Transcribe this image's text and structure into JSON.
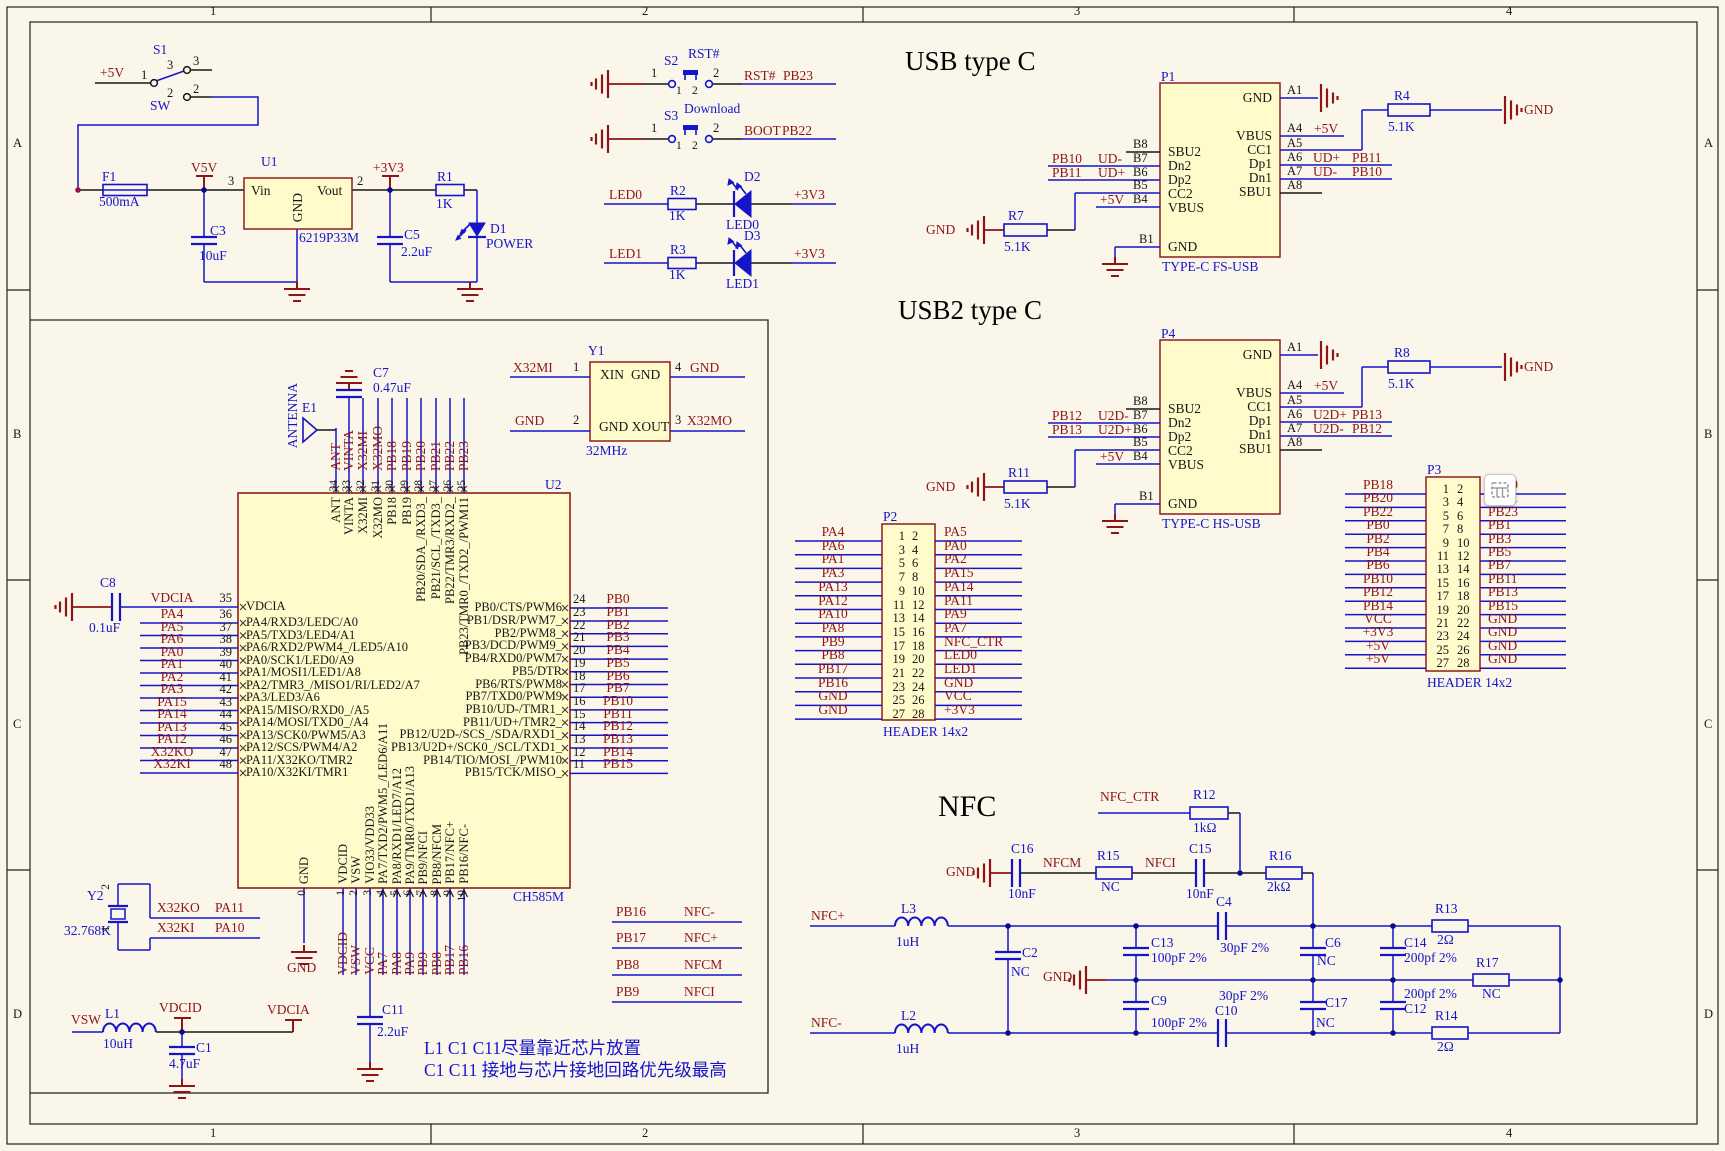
{
  "frame": {
    "cols": [
      "1",
      "2",
      "3",
      "4"
    ],
    "rows": [
      "A",
      "B",
      "C",
      "D"
    ]
  },
  "titles": {
    "usb1": "USB type C",
    "usb2": "USB2 type C",
    "nfc": "NFC"
  },
  "notes": [
    "L1 C1 C11尽量靠近芯片放置",
    "C1 C11 接地与芯片接地回路优先级最高"
  ],
  "power": {
    "p5v": "+5V",
    "s1_ref": "S1",
    "s1_sw": "SW",
    "s1_p1": "1",
    "s1_p2i": "2",
    "s1_p2o": "2",
    "s1_p3i": "3",
    "s1_p3o": "3",
    "f1_ref": "F1",
    "f1_val": "500mA",
    "v5v": "V5V",
    "u1_ref": "U1",
    "u1_vin": "Vin",
    "u1_vout": "Vout",
    "u1_gnd": "GND",
    "u1_val": "6219P33M",
    "u1_pin3": "3",
    "u1_pin2": "2",
    "p3v3": "+3V3",
    "r1_ref": "R1",
    "r1_val": "1K",
    "d1_ref": "D1",
    "d1_val": "POWER",
    "c3_ref": "C3",
    "c3_val": "10uF",
    "c5_ref": "C5",
    "c5_val": "2.2uF"
  },
  "buttons": {
    "s2_ref": "S2",
    "s2_val": "RST#",
    "s2_p1": "1",
    "s2_p2": "2",
    "s2_p1i": "1",
    "s2_p2i": "2",
    "s2_net1": "RST#",
    "s2_net2": "PB23",
    "s3_ref": "S3",
    "s3_val": "Download",
    "s3_p1": "1",
    "s3_p2": "2",
    "s3_p1i": "1",
    "s3_p2i": "2",
    "s3_net1": "BOOT",
    "s3_net2": "PB22",
    "led0_net": "LED0",
    "r2_ref": "R2",
    "r2_val": "1K",
    "d2_ref": "D2",
    "d2_val": "LED0",
    "led0_vcc": "+3V3",
    "led1_net": "LED1",
    "r3_ref": "R3",
    "r3_val": "1K",
    "d3_ref": "D3",
    "d3_val": "LED1",
    "led1_vcc": "+3V3"
  },
  "usb1": {
    "ref": "P1",
    "type": "TYPE-C FS-USB",
    "gnd": "GND",
    "a1": "A1",
    "gnd_a1": "GND",
    "vbus_r": "VBUS",
    "a4": "A4",
    "a4_net": "+5V",
    "cc1": "CC1",
    "a5": "A5",
    "r_top_ref": "R4",
    "r_top_val": "5.1K",
    "dp1": "Dp1",
    "a6": "A6",
    "a6_net": "UD+",
    "a6_net2": "PB11",
    "dn1": "Dn1",
    "a7": "A7",
    "a7_net": "UD-",
    "a7_net2": "PB10",
    "sbu1": "SBU1",
    "a8": "A8",
    "b8": "B8",
    "sbu2": "SBU2",
    "b7": "B7",
    "b7_net": "PB10",
    "b7_net2": "UD-",
    "dn2": "Dn2",
    "b6": "B6",
    "b6_net": "PB11",
    "b6_net2": "UD+",
    "dp2": "Dp2",
    "b5": "B5",
    "cc2": "CC2",
    "b4": "B4",
    "b4_net": "+5V",
    "vbus_l": "VBUS",
    "b1": "B1",
    "gnd_b1": "GND",
    "r_cc_ref": "R7",
    "r_cc_val": "5.1K"
  },
  "usb2": {
    "ref": "P4",
    "type": "TYPE-C HS-USB",
    "gnd": "GND",
    "a1": "A1",
    "gnd_a1": "GND",
    "vbus_r": "VBUS",
    "a4": "A4",
    "a4_net": "+5V",
    "cc1": "CC1",
    "a5": "A5",
    "r_top_ref": "R8",
    "r_top_val": "5.1K",
    "dp1": "Dp1",
    "a6": "A6",
    "a6_net": "U2D+",
    "a6_net2": "PB13",
    "dn1": "Dn1",
    "a7": "A7",
    "a7_net": "U2D-",
    "a7_net2": "PB12",
    "sbu1": "SBU1",
    "a8": "A8",
    "b8": "B8",
    "sbu2": "SBU2",
    "b7": "B7",
    "b7_net": "PB12",
    "b7_net2": "U2D-",
    "dn2": "Dn2",
    "b6": "B6",
    "b6_net": "PB13",
    "b6_net2": "U2D+",
    "dp2": "Dp2",
    "b5": "B5",
    "cc2": "CC2",
    "b4": "B4",
    "b4_net": "+5V",
    "vbus_l": "VBUS",
    "b1": "B1",
    "gnd_b1": "GND",
    "r_cc_ref": "R11",
    "r_cc_val": "5.1K"
  },
  "mcu": {
    "ref": "U2",
    "part": "CH585M",
    "e1_ref": "E1",
    "antenna": "ANTENNA",
    "c7_ref": "C7",
    "c7_val": "0.47uF",
    "c8_ref": "C8",
    "c8_val": "0.1uF",
    "left": [
      {
        "num": "35",
        "net": "VDCIA",
        "name": "VDCIA"
      },
      {
        "num": "36",
        "net": "PA4",
        "name": "PA4/RXD3/LEDC/A0"
      },
      {
        "num": "37",
        "net": "PA5",
        "name": "PA5/TXD3/LED4/A1"
      },
      {
        "num": "38",
        "net": "PA6",
        "name": "PA6/RXD2/PWM4_/LED5/A10"
      },
      {
        "num": "39",
        "net": "PA0",
        "name": "PA0/SCK1/LED0/A9"
      },
      {
        "num": "40",
        "net": "PA1",
        "name": "PA1/MOSI1/LED1/A8"
      },
      {
        "num": "41",
        "net": "PA2",
        "name": "PA2/TMR3_/MISO1/RI/LED2/A7"
      },
      {
        "num": "42",
        "net": "PA3",
        "name": "PA3/LED3/A6"
      },
      {
        "num": "43",
        "net": "PA15",
        "name": "PA15/MISO/RXD0_/A5"
      },
      {
        "num": "44",
        "net": "PA14",
        "name": "PA14/MOSI/TXD0_/A4"
      },
      {
        "num": "45",
        "net": "PA13",
        "name": "PA13/SCK0/PWM5/A3"
      },
      {
        "num": "46",
        "net": "PA12",
        "name": "PA12/SCS/PWM4/A2"
      },
      {
        "num": "47",
        "net": "X32KO",
        "name": "PA11/X32KO/TMR2"
      },
      {
        "num": "48",
        "net": "X32KI",
        "name": "PA10/X32KI/TMR1"
      }
    ],
    "right": [
      {
        "num": "24",
        "net": "PB0",
        "name": "PB0/CTS/PWM6"
      },
      {
        "num": "23",
        "net": "PB1",
        "name": "PB1/DSR/PWM7_"
      },
      {
        "num": "22",
        "net": "PB2",
        "name": "PB2/PWM8_"
      },
      {
        "num": "21",
        "net": "PB3",
        "name": "PB3/DCD/PWM9_"
      },
      {
        "num": "20",
        "net": "PB4",
        "name": "PB4/RXD0/PWM7"
      },
      {
        "num": "19",
        "net": "PB5",
        "name": "PB5/DTR"
      },
      {
        "num": "18",
        "net": "PB6",
        "name": "PB6/RTS/PWM8"
      },
      {
        "num": "17",
        "net": "PB7",
        "name": "PB7/TXD0/PWM9"
      },
      {
        "num": "16",
        "net": "PB10",
        "name": "PB10/UD-/TMR1_"
      },
      {
        "num": "15",
        "net": "PB11",
        "name": "PB11/UD+/TMR2_"
      },
      {
        "num": "14",
        "net": "PB12",
        "name": "PB12/U2D-/SCS_/SDA/RXD1_"
      },
      {
        "num": "13",
        "net": "PB13",
        "name": "PB13/U2D+/SCK0_/SCL/TXD1_"
      },
      {
        "num": "12",
        "net": "PB14",
        "name": "PB14/TIO/MOSI_/PWM10"
      },
      {
        "num": "11",
        "net": "PB15",
        "name": "PB15/TCK/MISO_"
      }
    ],
    "top": [
      {
        "num": "34",
        "net": "ANT",
        "name": "ANT"
      },
      {
        "num": "33",
        "net": "VINTA",
        "name": "VINTA"
      },
      {
        "num": "32",
        "net": "X32MI",
        "name": "X32MI"
      },
      {
        "num": "31",
        "net": "X32MO",
        "name": "X32MO"
      },
      {
        "num": "30",
        "net": "PB18",
        "name": "PB18"
      },
      {
        "num": "29",
        "net": "PB19",
        "name": "PB19"
      },
      {
        "num": "28",
        "net": "PB20",
        "name": "PB20/SDA_/RXD3_"
      },
      {
        "num": "27",
        "net": "PB21",
        "name": "PB21/SCL_/TXD3_"
      },
      {
        "num": "26",
        "net": "PB22",
        "name": "PB22/TMR3/RXD2_"
      },
      {
        "num": "25",
        "net": "PB23",
        "name": "PB23/TMR0_/TXD2_/PWM11"
      }
    ],
    "bottom": [
      {
        "num": "0",
        "net": "",
        "name": "GND"
      },
      {
        "num": "1",
        "net": "VDCID",
        "name": "VDCID"
      },
      {
        "num": "2",
        "net": "VSW",
        "name": "VSW"
      },
      {
        "num": "3",
        "net": "VCC",
        "name": "VIO33/VDD33"
      },
      {
        "num": "4",
        "net": "PA7",
        "name": "PA7/TXD2/PWM5_/LED6/A11"
      },
      {
        "num": "5",
        "net": "PA8",
        "name": "PA8/RXD1/LED7/A12"
      },
      {
        "num": "6",
        "net": "PA9",
        "name": "PA9/TMR0/TXD1/A13"
      },
      {
        "num": "7",
        "net": "PB9",
        "name": "PB9/NFCI"
      },
      {
        "num": "8",
        "net": "PB8",
        "name": "PB8/NFCM"
      },
      {
        "num": "9",
        "net": "PB17",
        "name": "PB17/NFC+"
      },
      {
        "num": "10",
        "net": "PB16",
        "name": "PB16/NFC-"
      }
    ]
  },
  "y1": {
    "ref": "Y1",
    "xin": "XIN",
    "gnd_r": "GND",
    "gndxout": "GND XOUT",
    "freq": "32MHz",
    "p1": "1",
    "p2": "2",
    "p3": "3",
    "p4": "4",
    "n1": "X32MI",
    "n2": "GND",
    "n3": "X32MO",
    "n4": "GND"
  },
  "p2": {
    "ref": "P2",
    "caption": "HEADER 14x2",
    "rows": [
      [
        "PA4",
        "1",
        "2",
        "PA5"
      ],
      [
        "PA6",
        "3",
        "4",
        "PA0"
      ],
      [
        "PA1",
        "5",
        "6",
        "PA2"
      ],
      [
        "PA3",
        "7",
        "8",
        "PA15"
      ],
      [
        "PA13",
        "9",
        "10",
        "PA14"
      ],
      [
        "PA12",
        "11",
        "12",
        "PA11"
      ],
      [
        "PA10",
        "13",
        "14",
        "PA9"
      ],
      [
        "PA8",
        "15",
        "16",
        "PA7"
      ],
      [
        "PB9",
        "17",
        "18",
        "NFC_CTR"
      ],
      [
        "PB8",
        "19",
        "20",
        "LED0"
      ],
      [
        "PB17",
        "21",
        "22",
        "LED1"
      ],
      [
        "PB16",
        "23",
        "24",
        "GND"
      ],
      [
        "GND",
        "25",
        "26",
        "VCC"
      ],
      [
        "GND",
        "27",
        "28",
        "+3V3"
      ]
    ]
  },
  "p3": {
    "ref": "P3",
    "caption": "HEADER 14x2",
    "rows": [
      [
        "PB18",
        "1",
        "2",
        "PB19"
      ],
      [
        "PB20",
        "3",
        "4",
        "PB21"
      ],
      [
        "PB22",
        "5",
        "6",
        "PB23"
      ],
      [
        "PB0",
        "7",
        "8",
        "PB1"
      ],
      [
        "PB2",
        "9",
        "10",
        "PB3"
      ],
      [
        "PB4",
        "11",
        "12",
        "PB5"
      ],
      [
        "PB6",
        "13",
        "14",
        "PB7"
      ],
      [
        "PB10",
        "15",
        "16",
        "PB11"
      ],
      [
        "PB12",
        "17",
        "18",
        "PB13"
      ],
      [
        "PB14",
        "19",
        "20",
        "PB15"
      ],
      [
        "VCC",
        "21",
        "22",
        "GND"
      ],
      [
        "+3V3",
        "23",
        "24",
        "GND"
      ],
      [
        "+5V",
        "25",
        "26",
        "GND"
      ],
      [
        "+5V",
        "27",
        "28",
        "GND"
      ]
    ]
  },
  "nfc_nets": [
    [
      "PB16",
      "NFC-"
    ],
    [
      "PB17",
      "NFC+"
    ],
    [
      "PB8",
      "NFCM"
    ],
    [
      "PB9",
      "NFCI"
    ]
  ],
  "nfc": {
    "ctr": "NFC_CTR",
    "r12_ref": "R12",
    "r12_val": "1kΩ",
    "gnd1": "GND",
    "c16_ref": "C16",
    "c16_val": "10nF",
    "nfcm": "NFCM",
    "r15_ref": "R15",
    "r15_val": "NC",
    "nfci": "NFCI",
    "c15_ref": "C15",
    "c15_val": "10nF",
    "r16_ref": "R16",
    "r16_val": "2kΩ",
    "nfcp": "NFC+",
    "l3_ref": "L3",
    "l3_val": "1uH",
    "c2_ref": "C2",
    "c2_val": "NC",
    "gnd2": "GND",
    "c13_ref": "C13",
    "c13_val": "100pF 2%",
    "c4_ref": "C4",
    "c4_val": "30pF 2%",
    "c6_ref": "C6",
    "c6_val": "NC",
    "c14_ref": "C14",
    "c14_val": "200pf 2%",
    "r13_ref": "R13",
    "r13_val": "2Ω",
    "r17_ref": "R17",
    "r17_val": "NC",
    "nfcn": "NFC-",
    "l2_ref": "L2",
    "l2_val": "1uH",
    "c9_ref": "C9",
    "c9_val": "100pF 2%",
    "c10_ref": "C10",
    "c10_val": "30pF 2%",
    "c17_ref": "C17",
    "c17_val": "NC",
    "c12_ref": "C12",
    "c12_val": "200pf 2%",
    "r14_ref": "R14",
    "r14_val": "2Ω"
  },
  "bl": {
    "y2_ref": "Y2",
    "y2_val": "32.768K",
    "y2_p1": "1",
    "y2_p2": "2",
    "x32ko": "X32KO",
    "pa11": "PA11",
    "x32ki": "X32KI",
    "pa10": "PA10",
    "vsw": "VSW",
    "l1_ref": "L1",
    "l1_val": "10uH",
    "vdcid": "VDCID",
    "vdcia": "VDCIA",
    "c1_ref": "C1",
    "c1_val": "4.7uF",
    "gnd0": "GND",
    "c11_ref": "C11",
    "c11_val": "2.2uF"
  },
  "icon": {
    "name": "grid-selection-icon"
  }
}
